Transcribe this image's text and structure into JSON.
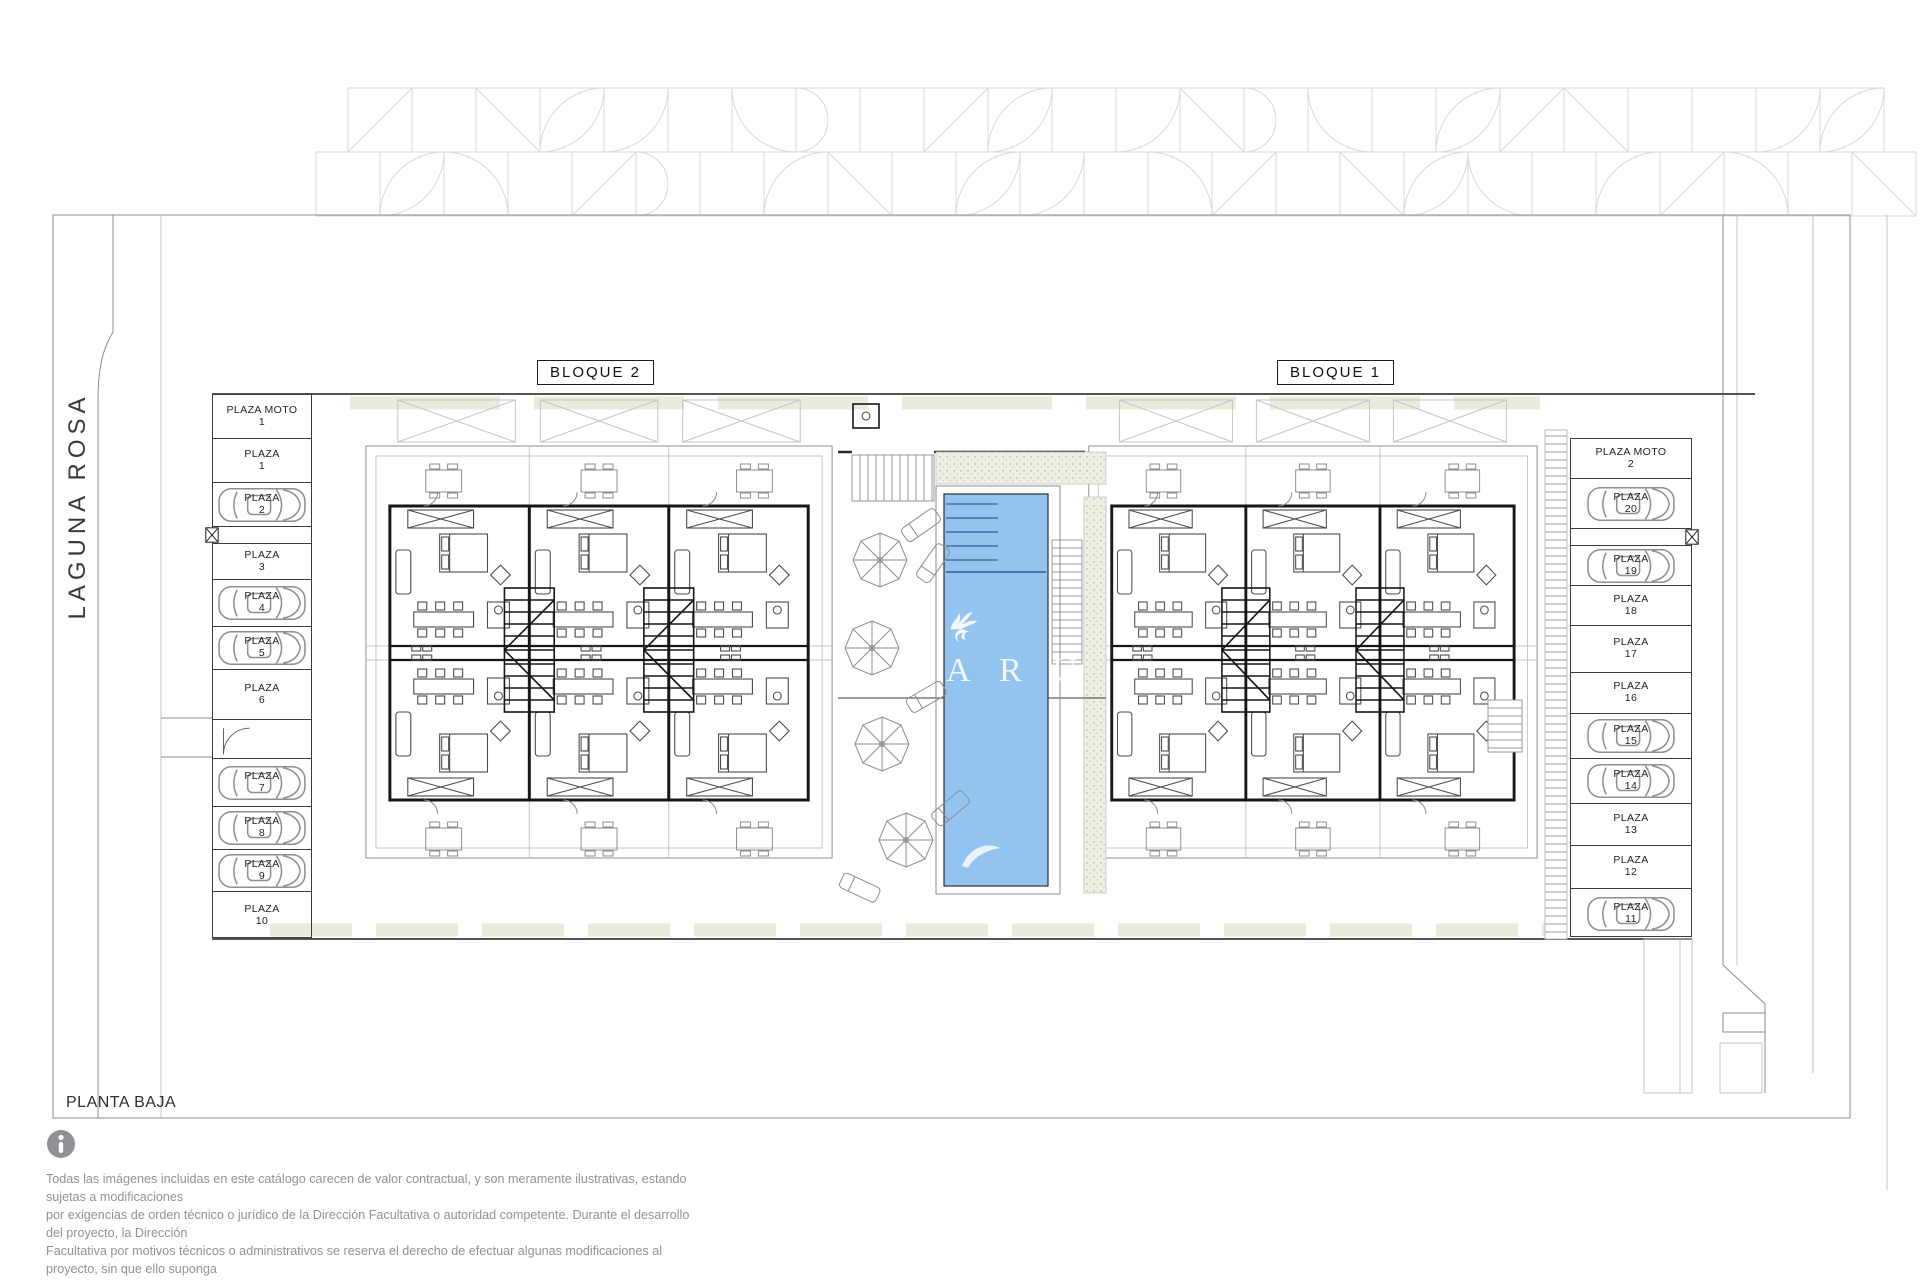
{
  "plan": {
    "title": "PLANTA BAJA",
    "street_name": "LAGUNA ROSA",
    "blocks": [
      {
        "label": "BLOQUE 2"
      },
      {
        "label": "BLOQUE 1"
      }
    ],
    "watermark": {
      "logo": "griffin-logo",
      "letters": "A R U"
    },
    "parking_left": [
      {
        "label": "PLAZA MOTO",
        "num": "1",
        "car": false
      },
      {
        "label": "PLAZA",
        "num": "1",
        "car": false
      },
      {
        "label": "PLAZA",
        "num": "2",
        "car": true
      },
      {
        "label": "PLAZA",
        "num": "3",
        "car": false
      },
      {
        "label": "PLAZA",
        "num": "4",
        "car": true
      },
      {
        "label": "PLAZA",
        "num": "5",
        "car": true
      },
      {
        "label": "PLAZA",
        "num": "6",
        "car": false
      },
      {
        "label": "PLAZA",
        "num": "7",
        "car": true
      },
      {
        "label": "PLAZA",
        "num": "8",
        "car": true
      },
      {
        "label": "PLAZA",
        "num": "9",
        "car": true
      },
      {
        "label": "PLAZA",
        "num": "10",
        "car": false
      }
    ],
    "parking_right": [
      {
        "label": "PLAZA MOTO",
        "num": "2",
        "car": false
      },
      {
        "label": "PLAZA",
        "num": "20",
        "car": true
      },
      {
        "label": "PLAZA",
        "num": "19",
        "car": true
      },
      {
        "label": "PLAZA",
        "num": "18",
        "car": false
      },
      {
        "label": "PLAZA",
        "num": "17",
        "car": false
      },
      {
        "label": "PLAZA",
        "num": "16",
        "car": false
      },
      {
        "label": "PLAZA",
        "num": "15",
        "car": true
      },
      {
        "label": "PLAZA",
        "num": "14",
        "car": true
      },
      {
        "label": "PLAZA",
        "num": "13",
        "car": false
      },
      {
        "label": "PLAZA",
        "num": "12",
        "car": false
      },
      {
        "label": "PLAZA",
        "num": "11",
        "car": true
      }
    ]
  },
  "footer": {
    "info_icon": "info-icon",
    "disclaimer_lines": [
      "Todas las imágenes incluidas en este catálogo carecen de valor contractual, y son meramente ilustrativas, estando sujetas a modificaciones",
      "por exigencias de orden técnico o jurídico de la Dirección Facultativa o autoridad competente. Durante el desarrollo del proyecto, la Dirección",
      "Facultativa por motivos técnicos o administrativos se reserva el derecho de efectuar algunas modificaciones al proyecto, sin que ello suponga",
      "disminución en la calidad de los materiales. El mobiliario de las infografías interiores no está incluido, y el equipamiento de las viviendas será",
      "el indicado en la correspondiente memoria de calidades."
    ]
  },
  "colors": {
    "pool_water": "#93c4f0",
    "pool_steps": "#3f6f9f",
    "deck": "#e9ebdd",
    "wall_dark": "#161616",
    "line_light": "#8d8d92",
    "pattern_band": "#d9d9df",
    "text_gray": "#929292"
  }
}
